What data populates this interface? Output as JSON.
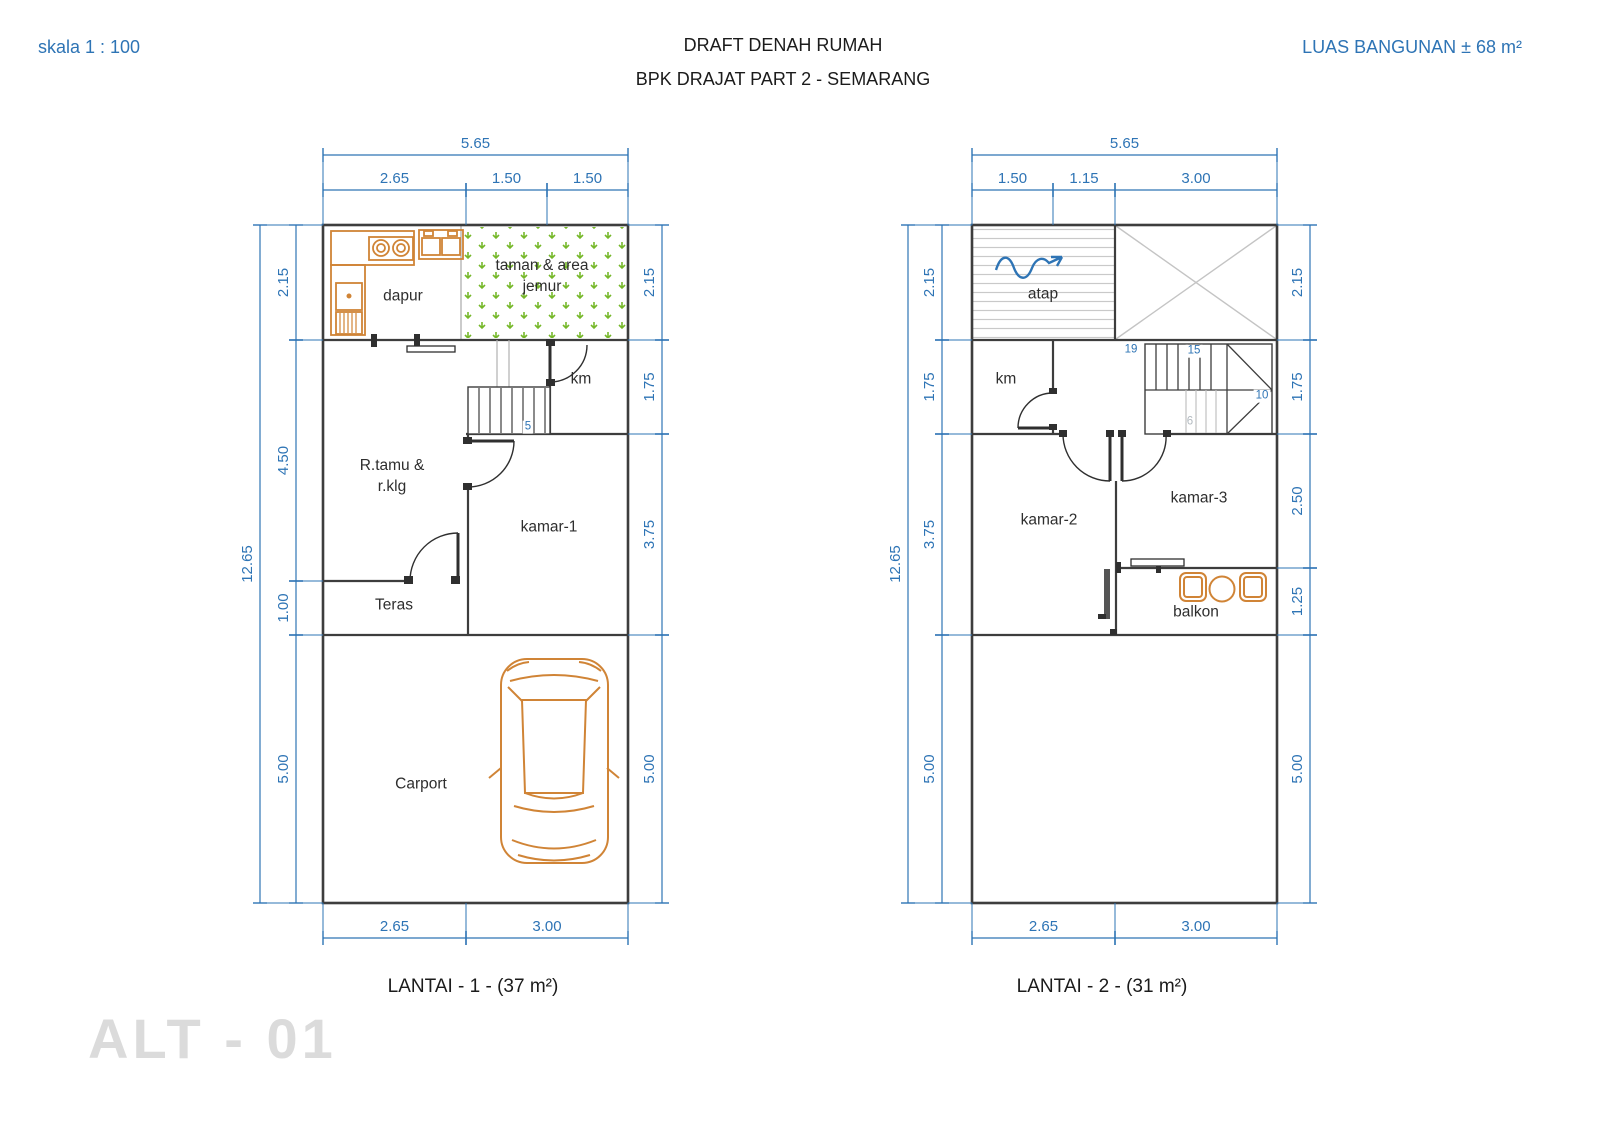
{
  "header": {
    "scale_label": "skala 1 : 100",
    "title_line1": "DRAFT DENAH RUMAH",
    "title_line2": "BPK DRAJAT PART 2 - SEMARANG",
    "building_area_label": "LUAS BANGUNAN ± 68 m²"
  },
  "watermark": "ALT - 01",
  "colors": {
    "dimension_blue": "#2e74b5",
    "wall_dark": "#3d3d3d",
    "fixture_orange": "#d08436",
    "plant_green": "#76b82a",
    "roof_gray": "#c9c9c9",
    "watermark_gray": "#dbdbdb"
  },
  "plans": [
    {
      "id": "lantai-1",
      "caption": "LANTAI - 1 - (37 m²)",
      "room_labels": [
        {
          "name": "dapur",
          "text": "dapur",
          "x": 403,
          "y": 297
        },
        {
          "name": "taman-jemur",
          "text": "taman & area\njemur",
          "x": 542,
          "y": 277
        },
        {
          "name": "km",
          "text": "km",
          "x": 581,
          "y": 380
        },
        {
          "name": "r-tamu",
          "text": "R.tamu &\nr.klg",
          "x": 392,
          "y": 477
        },
        {
          "name": "kamar-1",
          "text": "kamar-1",
          "x": 549,
          "y": 528
        },
        {
          "name": "teras",
          "text": "Teras",
          "x": 394,
          "y": 606
        },
        {
          "name": "carport",
          "text": "Carport",
          "x": 421,
          "y": 785
        }
      ],
      "stair_numbers": [
        {
          "text": "5",
          "x": 528,
          "y": 427,
          "muted": false
        }
      ],
      "dimensions": [
        {
          "o": "h",
          "a": 155,
          "from": 323,
          "to": 628,
          "label": "5.65",
          "ext": 70
        },
        {
          "o": "h",
          "a": 190,
          "from": 323,
          "to": 466,
          "label": "2.65",
          "ext": 35
        },
        {
          "o": "h",
          "a": 190,
          "from": 466,
          "to": 547,
          "label": "1.50",
          "ext": 35
        },
        {
          "o": "h",
          "a": 190,
          "from": 547,
          "to": 628,
          "label": "1.50",
          "ext": 35
        },
        {
          "o": "v",
          "a": 260,
          "from": 225,
          "to": 903,
          "label": "12.65",
          "ext": 56
        },
        {
          "o": "v",
          "a": 296,
          "from": 225,
          "to": 340,
          "label": "2.15",
          "ext": 27
        },
        {
          "o": "v",
          "a": 296,
          "from": 340,
          "to": 581,
          "label": "4.50",
          "ext": 27
        },
        {
          "o": "v",
          "a": 296,
          "from": 581,
          "to": 635,
          "label": "1.00",
          "ext": 27
        },
        {
          "o": "v",
          "a": 296,
          "from": 635,
          "to": 903,
          "label": "5.00",
          "ext": 27
        },
        {
          "o": "v",
          "a": 662,
          "from": 225,
          "to": 340,
          "label": "2.15",
          "ext": -34
        },
        {
          "o": "v",
          "a": 662,
          "from": 340,
          "to": 434,
          "label": "1.75",
          "ext": -34
        },
        {
          "o": "v",
          "a": 662,
          "from": 434,
          "to": 635,
          "label": "3.75",
          "ext": -34
        },
        {
          "o": "v",
          "a": 662,
          "from": 635,
          "to": 903,
          "label": "5.00",
          "ext": -34
        },
        {
          "o": "h",
          "a": 938,
          "from": 323,
          "to": 466,
          "label": "2.65",
          "ext": -35
        },
        {
          "o": "h",
          "a": 938,
          "from": 466,
          "to": 628,
          "label": "3.00",
          "ext": -35
        }
      ]
    },
    {
      "id": "lantai-2",
      "caption": "LANTAI - 2 - (31 m²)",
      "room_labels": [
        {
          "name": "atap",
          "text": "atap",
          "x": 1043,
          "y": 295
        },
        {
          "name": "km-2",
          "text": "km",
          "x": 1006,
          "y": 380
        },
        {
          "name": "kamar-2",
          "text": "kamar-2",
          "x": 1049,
          "y": 521
        },
        {
          "name": "kamar-3",
          "text": "kamar-3",
          "x": 1199,
          "y": 499
        },
        {
          "name": "balkon",
          "text": "balkon",
          "x": 1196,
          "y": 613
        }
      ],
      "stair_numbers": [
        {
          "text": "19",
          "x": 1131,
          "y": 350,
          "muted": false
        },
        {
          "text": "15",
          "x": 1194,
          "y": 351,
          "muted": false
        },
        {
          "text": "10",
          "x": 1262,
          "y": 396,
          "muted": false
        },
        {
          "text": "6",
          "x": 1190,
          "y": 422,
          "muted": true
        }
      ],
      "dimensions": [
        {
          "o": "h",
          "a": 155,
          "from": 972,
          "to": 1277,
          "label": "5.65",
          "ext": 70
        },
        {
          "o": "h",
          "a": 190,
          "from": 972,
          "to": 1053,
          "label": "1.50",
          "ext": 35
        },
        {
          "o": "h",
          "a": 190,
          "from": 1053,
          "to": 1115,
          "label": "1.15",
          "ext": 35
        },
        {
          "o": "h",
          "a": 190,
          "from": 1115,
          "to": 1277,
          "label": "3.00",
          "ext": 35
        },
        {
          "o": "v",
          "a": 908,
          "from": 225,
          "to": 903,
          "label": "12.65",
          "ext": 60
        },
        {
          "o": "v",
          "a": 942,
          "from": 225,
          "to": 340,
          "label": "2.15",
          "ext": 30
        },
        {
          "o": "v",
          "a": 942,
          "from": 340,
          "to": 434,
          "label": "1.75",
          "ext": 30
        },
        {
          "o": "v",
          "a": 942,
          "from": 434,
          "to": 635,
          "label": "3.75",
          "ext": 30
        },
        {
          "o": "v",
          "a": 942,
          "from": 635,
          "to": 903,
          "label": "5.00",
          "ext": 30
        },
        {
          "o": "v",
          "a": 1310,
          "from": 225,
          "to": 340,
          "label": "2.15",
          "ext": -33
        },
        {
          "o": "v",
          "a": 1310,
          "from": 340,
          "to": 434,
          "label": "1.75",
          "ext": -33
        },
        {
          "o": "v",
          "a": 1310,
          "from": 434,
          "to": 568,
          "label": "2.50",
          "ext": -33
        },
        {
          "o": "v",
          "a": 1310,
          "from": 568,
          "to": 635,
          "label": "1.25",
          "ext": -33
        },
        {
          "o": "v",
          "a": 1310,
          "from": 635,
          "to": 903,
          "label": "5.00",
          "ext": -33
        },
        {
          "o": "h",
          "a": 938,
          "from": 972,
          "to": 1115,
          "label": "2.65",
          "ext": -35
        },
        {
          "o": "h",
          "a": 938,
          "from": 1115,
          "to": 1277,
          "label": "3.00",
          "ext": -35
        }
      ]
    }
  ]
}
